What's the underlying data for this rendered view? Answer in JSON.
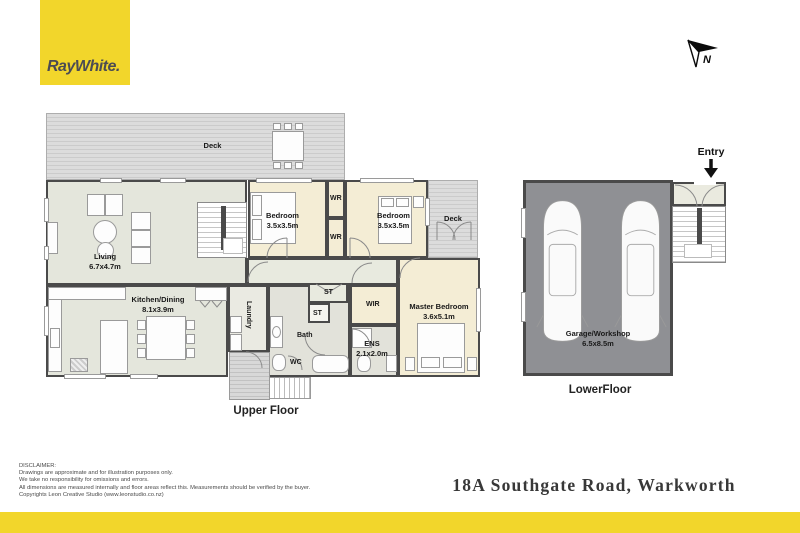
{
  "brand": {
    "logo_text": "RayWhite."
  },
  "compass": {
    "letter": "N"
  },
  "plan": {
    "upper_floor_label": "Upper Floor",
    "lower_floor_label": "LowerFloor",
    "entry_label": "Entry",
    "rooms": {
      "deck_top": {
        "name": "Deck"
      },
      "deck_right": {
        "name": "Deck"
      },
      "living": {
        "name": "Living",
        "dims": "6.7x4.7m"
      },
      "kitchen_dining": {
        "name": "Kitchen/Dining",
        "dims": "8.1x3.9m"
      },
      "bedroom_1": {
        "name": "Bedroom",
        "dims": "3.5x3.5m"
      },
      "bedroom_2": {
        "name": "Bedroom",
        "dims": "3.5x3.5m"
      },
      "master_bedroom": {
        "name": "Master Bedroom",
        "dims": "3.6x5.1m"
      },
      "ensuite": {
        "name": "ENS",
        "dims": "2.1x2.0m"
      },
      "garage": {
        "name": "Garage/Workshop",
        "dims": "6.5x8.5m"
      },
      "wr_top": {
        "name": "WR"
      },
      "wr_bottom": {
        "name": "WR"
      },
      "wir": {
        "name": "WIR"
      },
      "st_top": {
        "name": "ST"
      },
      "st_small": {
        "name": "ST"
      },
      "bath": {
        "name": "Bath"
      },
      "wc": {
        "name": "WC"
      },
      "laundry": {
        "name": "Laundry"
      }
    }
  },
  "footer": {
    "disclaimer": [
      "DISCLAIMER:",
      "Drawings are approximate and for illustration purposes only.",
      "We take no responsibility for omissions and errors.",
      "All dimensions are measured internally and floor areas reflect this. Measurements should be verified by the buyer.",
      "Copyrights Leon Creative Studio (www.leonstudio.co.nz)"
    ],
    "address": "18A Southgate Road, Warkworth"
  },
  "colors": {
    "brand_yellow": "#F2D62B",
    "wall": "#4A4A4A",
    "garage_fill": "#8F9094",
    "bedroom_fill": "#F4EDD5",
    "living_fill": "#E4E6DC"
  }
}
